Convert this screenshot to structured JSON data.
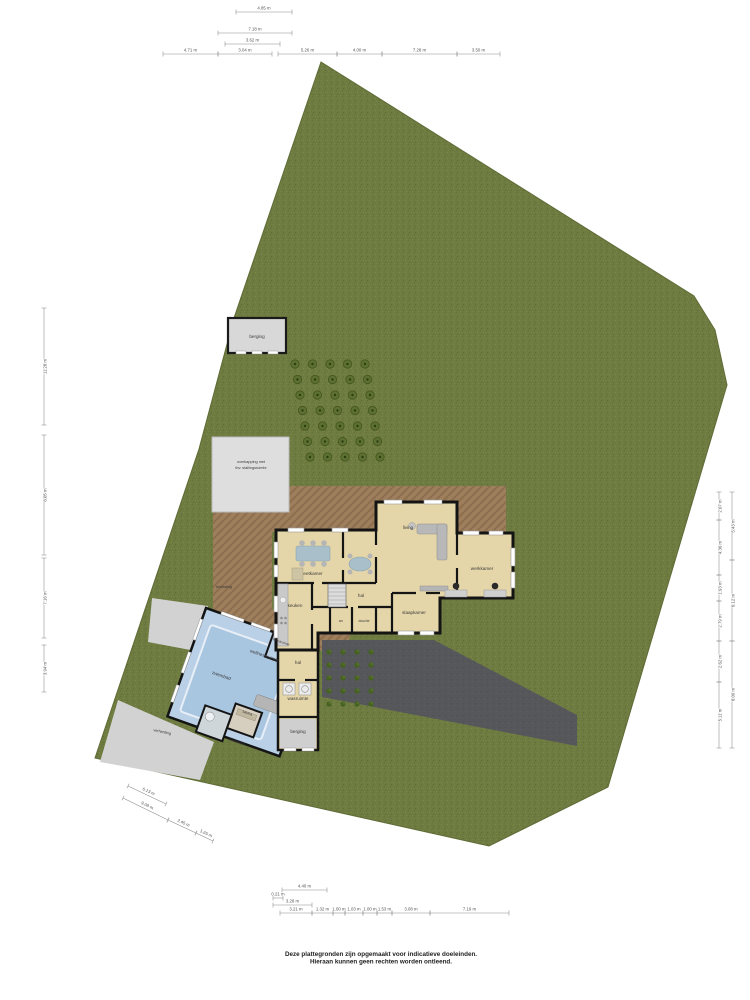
{
  "meta": {
    "disclaimer_line1": "Deze plattegronden zijn opgemaakt voor indicatieve doeleinden.",
    "disclaimer_line2": "Hieraan kunnen geen rechten worden ontleend."
  },
  "colors": {
    "background": "#ffffff",
    "garden": "#6e7c41",
    "garden_dark": "#5f6d35",
    "garden_light": "#7b8a4b",
    "terrace": "#997a59",
    "terrace_dark": "#82674a",
    "driveway": "#56575b",
    "house_fill": "#e5d6a9",
    "wall": "#141414",
    "window": "#ffffff",
    "pool_area": "#bad0e7",
    "pool_water": "#a9c6e1",
    "outbuilding": "#d8d8d8",
    "path": "#d2d2d2",
    "furniture": "#b5b5b5",
    "table": "#a9bfc9",
    "tree_fill": "#5c7031",
    "tree_stroke": "#46551f",
    "veg_fill": "#46621f",
    "dimension": "#8a8a8a",
    "dimension_text": "#555555",
    "label_text": "#3a3a3a"
  },
  "room_labels": [
    {
      "text": "living",
      "x": 408,
      "y": 529,
      "rot": 0
    },
    {
      "text": "eetkamer",
      "x": 313,
      "y": 575,
      "rot": 0
    },
    {
      "text": "keuken",
      "x": 295,
      "y": 607,
      "rot": 0
    },
    {
      "text": "hal",
      "x": 361,
      "y": 597,
      "rot": 0
    },
    {
      "text": "wc",
      "x": 341,
      "y": 622,
      "rot": 0,
      "size": 3.4
    },
    {
      "text": "douche",
      "x": 364,
      "y": 622,
      "rot": 0,
      "size": 3.4
    },
    {
      "text": "slaapkamer",
      "x": 414,
      "y": 614,
      "rot": 0
    },
    {
      "text": "werkkamer",
      "x": 482,
      "y": 570,
      "rot": 0
    },
    {
      "text": "hal",
      "x": 298,
      "y": 664,
      "rot": 0
    },
    {
      "text": "wasruimte",
      "x": 298,
      "y": 700,
      "rot": 0
    },
    {
      "text": "berging",
      "x": 298,
      "y": 733,
      "rot": 0
    },
    {
      "text": "sauna",
      "x": 247,
      "y": 714,
      "rot": 19,
      "size": 3.8
    },
    {
      "text": "badkamer",
      "x": 237,
      "y": 743,
      "rot": 19,
      "size": 3.8
    },
    {
      "text": "kleedruimte",
      "x": 281,
      "y": 643,
      "rot": 19,
      "size": 3.3
    },
    {
      "text": "wellnessruimte",
      "x": 264,
      "y": 657,
      "rot": 19
    },
    {
      "text": "zwembad",
      "x": 221,
      "y": 677,
      "rot": 19
    },
    {
      "text": "berging",
      "x": 257,
      "y": 338,
      "rot": 0
    },
    {
      "text": "overkapping met",
      "x": 251,
      "y": 463,
      "rot": 0,
      "size": 3.8
    },
    {
      "text": "tbv. stallingsruimte",
      "x": 251,
      "y": 469,
      "rot": 0,
      "size": 3.8
    },
    {
      "text": "bestrating",
      "x": 224,
      "y": 588,
      "rot": 0,
      "size": 3.6
    },
    {
      "text": "verharding",
      "x": 162,
      "y": 733,
      "rot": 12,
      "size": 3.8
    }
  ],
  "dimensions": [
    {
      "x1": 236,
      "y1": 12,
      "x2": 292,
      "y2": 12,
      "label": "4.85 m"
    },
    {
      "x1": 218,
      "y1": 33,
      "x2": 292,
      "y2": 33,
      "label": "7.18 m"
    },
    {
      "x1": 225,
      "y1": 44,
      "x2": 280,
      "y2": 44,
      "label": "3.62 m"
    },
    {
      "x1": 163,
      "y1": 54,
      "x2": 218,
      "y2": 54,
      "label": "4.71 m"
    },
    {
      "x1": 218,
      "y1": 54,
      "x2": 272,
      "y2": 54,
      "label": "3.04 m"
    },
    {
      "x1": 278,
      "y1": 54,
      "x2": 337,
      "y2": 54,
      "label": "5.26 m"
    },
    {
      "x1": 337,
      "y1": 54,
      "x2": 382,
      "y2": 54,
      "label": "4.00 m"
    },
    {
      "x1": 382,
      "y1": 54,
      "x2": 457,
      "y2": 54,
      "label": "7.28 m"
    },
    {
      "x1": 457,
      "y1": 54,
      "x2": 500,
      "y2": 54,
      "label": "3.50 m"
    },
    {
      "x1": 282,
      "y1": 890,
      "x2": 327,
      "y2": 890,
      "label": "4.40 m"
    },
    {
      "x1": 273,
      "y1": 898,
      "x2": 283,
      "y2": 898,
      "label": "0.21 m"
    },
    {
      "x1": 273,
      "y1": 905,
      "x2": 312,
      "y2": 905,
      "label": "3.28 m"
    },
    {
      "x1": 280,
      "y1": 913,
      "x2": 312,
      "y2": 913,
      "label": "3.21 m"
    },
    {
      "x1": 312,
      "y1": 913,
      "x2": 333,
      "y2": 913,
      "label": "1.32 m"
    },
    {
      "x1": 333,
      "y1": 913,
      "x2": 345,
      "y2": 913,
      "label": "1.00 m"
    },
    {
      "x1": 345,
      "y1": 913,
      "x2": 363,
      "y2": 913,
      "label": "1.03 m"
    },
    {
      "x1": 363,
      "y1": 913,
      "x2": 377,
      "y2": 913,
      "label": "1.00 m"
    },
    {
      "x1": 377,
      "y1": 913,
      "x2": 392,
      "y2": 913,
      "label": "1.53 m"
    },
    {
      "x1": 392,
      "y1": 913,
      "x2": 430,
      "y2": 913,
      "label": "3.08 m"
    },
    {
      "x1": 430,
      "y1": 913,
      "x2": 509,
      "y2": 913,
      "label": "7.19 m"
    },
    {
      "x1": 123,
      "y1": 798,
      "x2": 168,
      "y2": 820,
      "label": "9.08 m"
    },
    {
      "x1": 168,
      "y1": 820,
      "x2": 196,
      "y2": 833,
      "label": "2.45 m"
    },
    {
      "x1": 196,
      "y1": 833,
      "x2": 213,
      "y2": 841,
      "label": "1.65 m"
    },
    {
      "x1": 128,
      "y1": 786,
      "x2": 166,
      "y2": 804,
      "label": "6.13 m"
    },
    {
      "x1": 44,
      "y1": 308,
      "x2": 44,
      "y2": 425,
      "label": "11.28 m"
    },
    {
      "x1": 44,
      "y1": 435,
      "x2": 44,
      "y2": 555,
      "label": "8.05 m"
    },
    {
      "x1": 44,
      "y1": 558,
      "x2": 44,
      "y2": 638,
      "label": "7.16 m"
    },
    {
      "x1": 44,
      "y1": 645,
      "x2": 44,
      "y2": 692,
      "label": "3.94 m"
    },
    {
      "x1": 719,
      "y1": 492,
      "x2": 719,
      "y2": 520,
      "label": "2.07 m"
    },
    {
      "x1": 719,
      "y1": 520,
      "x2": 719,
      "y2": 575,
      "label": "4.36 m"
    },
    {
      "x1": 719,
      "y1": 575,
      "x2": 719,
      "y2": 601,
      "label": "1.93 m"
    },
    {
      "x1": 719,
      "y1": 601,
      "x2": 719,
      "y2": 641,
      "label": "2.79 m"
    },
    {
      "x1": 719,
      "y1": 641,
      "x2": 719,
      "y2": 682,
      "label": "2.62 m"
    },
    {
      "x1": 719,
      "y1": 682,
      "x2": 719,
      "y2": 748,
      "label": "5.11 m"
    },
    {
      "x1": 732,
      "y1": 492,
      "x2": 732,
      "y2": 560,
      "label": "5.43 m"
    },
    {
      "x1": 732,
      "y1": 560,
      "x2": 732,
      "y2": 641,
      "label": "6.12 m"
    },
    {
      "x1": 732,
      "y1": 641,
      "x2": 732,
      "y2": 748,
      "label": "8.09 m"
    }
  ],
  "orchard": {
    "rows": 7,
    "cols": 5,
    "x0": 295,
    "y0": 364,
    "dx": 17.5,
    "dy": 15.5,
    "row_shift": 2.5
  },
  "moestuin": {
    "rows": 5,
    "cols": 4,
    "x0": 329,
    "y0": 652,
    "dx": 14,
    "dy": 13
  }
}
